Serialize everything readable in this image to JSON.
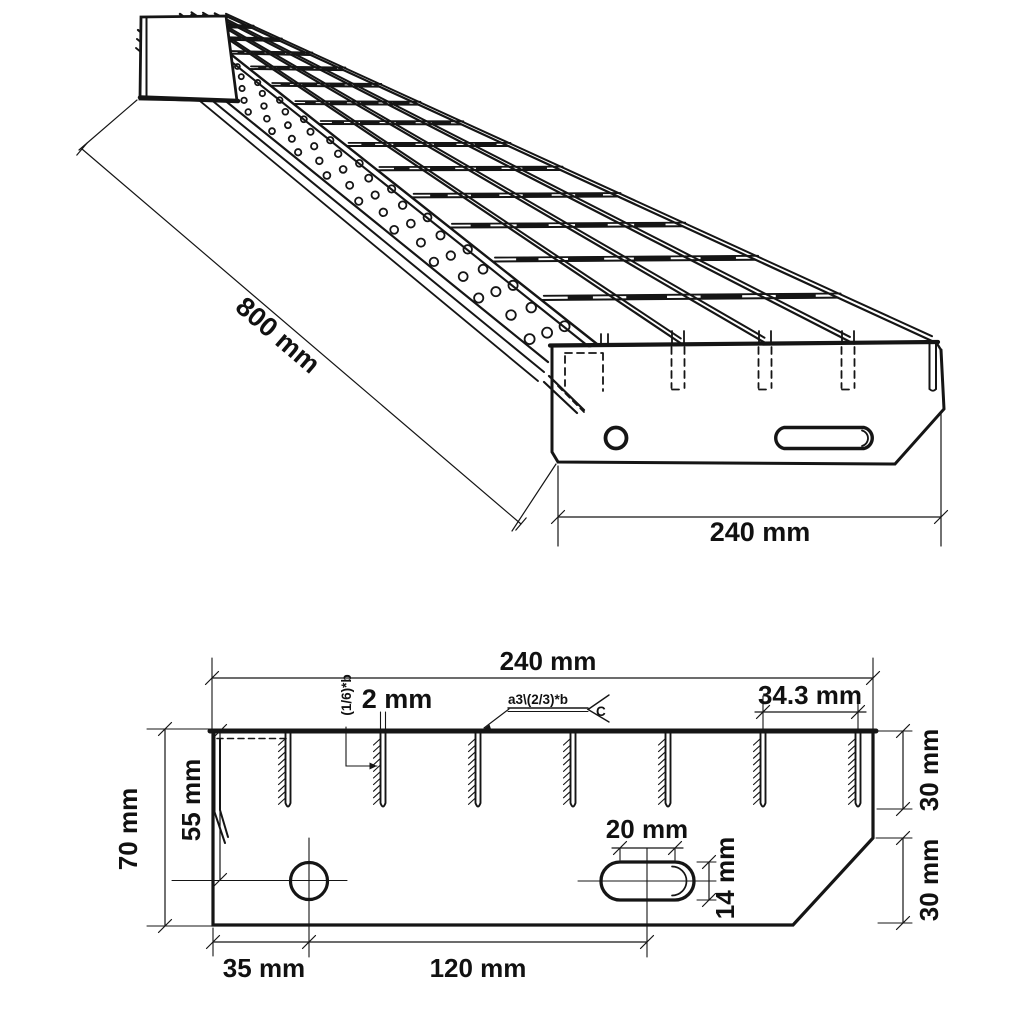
{
  "page": {
    "background": "#ffffff",
    "line_color": "#151515"
  },
  "isometric_view": {
    "length_dim": "800 mm",
    "width_dim": "240 mm"
  },
  "section_view": {
    "width_dim": "240 mm",
    "total_height_dim": "70 mm",
    "hole_center_from_top_dim": "55 mm",
    "hole_from_left_dim": "35 mm",
    "hole_to_slot_dim": "120 mm",
    "slot_length_dim": "20 mm",
    "slot_height_dim": "14 mm",
    "bar_depth_dim": "30 mm",
    "chamfer_depth_dim": "30 mm",
    "bar_spacing_dim": "34.3 mm",
    "bar_thickness_dim": "2 mm",
    "weld_note_vertical": "(1/6)*b",
    "weld_symbol_text": "a3\\(2/3)*b",
    "weld_symbol_tail": "C"
  }
}
